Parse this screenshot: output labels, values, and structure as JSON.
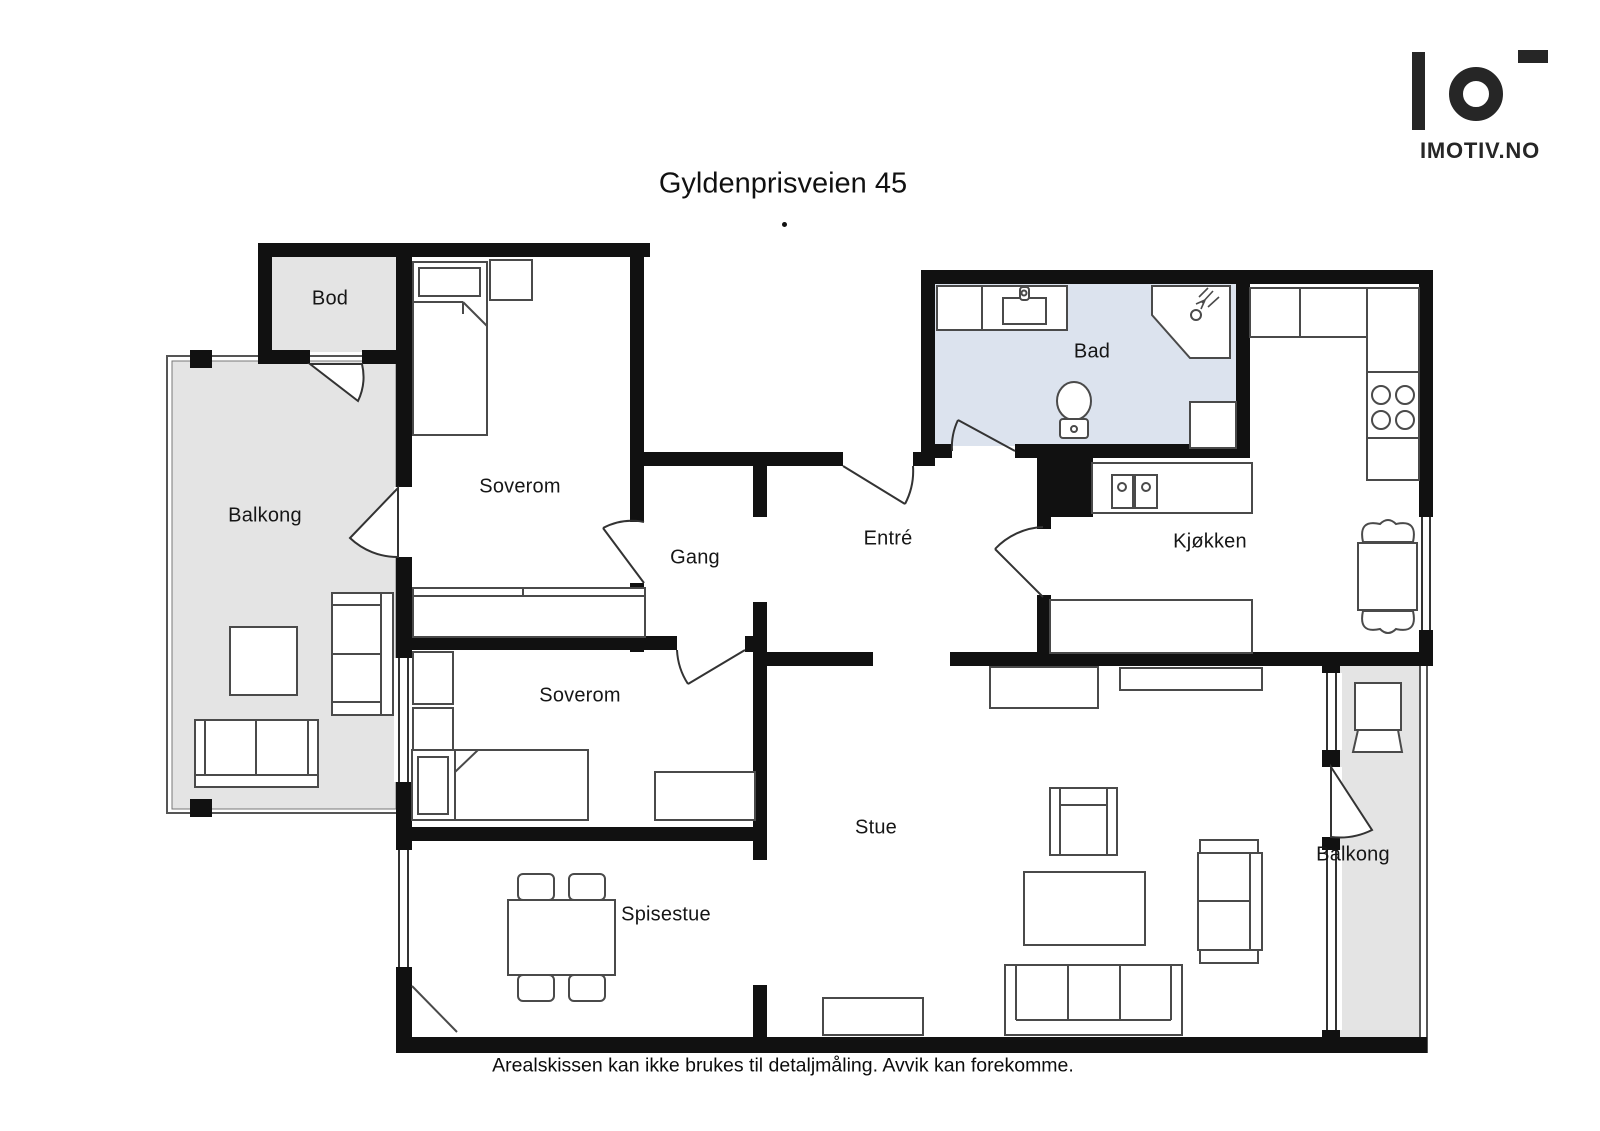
{
  "title": "Gyldenprisveien 45",
  "disclaimer": "Arealskissen kan ikke brukes til detaljmåling. Avvik kan forekomme.",
  "logo": {
    "brand": "IMOTIV.NO"
  },
  "rooms": [
    {
      "id": "bod",
      "label": "Bod"
    },
    {
      "id": "balkong-left",
      "label": "Balkong"
    },
    {
      "id": "soverom-1",
      "label": "Soverom"
    },
    {
      "id": "gang",
      "label": "Gang"
    },
    {
      "id": "entre",
      "label": "Entré"
    },
    {
      "id": "bad",
      "label": "Bad"
    },
    {
      "id": "kjokken",
      "label": "Kjøkken"
    },
    {
      "id": "soverom-2",
      "label": "Soverom"
    },
    {
      "id": "spisestue",
      "label": "Spisestue"
    },
    {
      "id": "stue",
      "label": "Stue"
    },
    {
      "id": "balkong-right",
      "label": "Balkong"
    }
  ],
  "colors": {
    "wall": "#111111",
    "balcony_floor": "#e4e4e4",
    "bathroom_floor": "#dce3ee",
    "furniture_line": "#4a4a4a",
    "text": "#111111",
    "logo": "#262626"
  },
  "icons": {
    "logo_mark": "bar-circle-dash",
    "fixtures": [
      "bed",
      "pillow",
      "nightstand",
      "wardrobe",
      "dining-table",
      "chair",
      "sofa",
      "armchair",
      "coffee-table",
      "sideboard",
      "tv-bench",
      "toilet",
      "shower",
      "bathroom-sink",
      "kitchen-sink",
      "stove",
      "counter",
      "balcony-table",
      "balcony-sofa",
      "door-swing",
      "window"
    ]
  }
}
